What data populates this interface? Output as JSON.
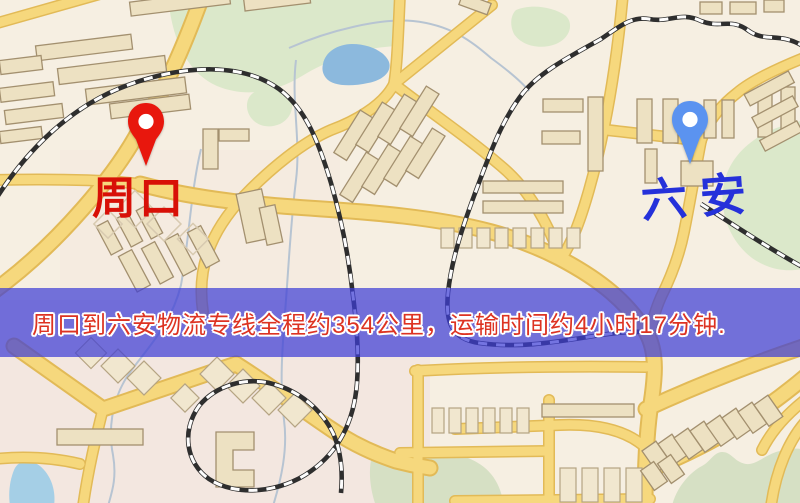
{
  "map": {
    "origin": {
      "name": "周口",
      "pin_color": "#e8170d",
      "label_color": "#d81007"
    },
    "destination": {
      "name": "六安",
      "pin_color": "#5b93f0",
      "label_color": "#2531da"
    },
    "route_banner": {
      "text": "周口到六安物流专线全程约354公里，运输时间约4小时17分钟.",
      "distance": "约354公里",
      "duration": "约4小时17分钟",
      "overlay_color": "#3e3ed6",
      "text_color": "#dd3322"
    },
    "legend_colors": {
      "road": "#f6d87d",
      "railway": "#2e2e2e",
      "park": "#dbe8ca",
      "water": "#8cb9dd",
      "background": "#f6efe2"
    }
  }
}
